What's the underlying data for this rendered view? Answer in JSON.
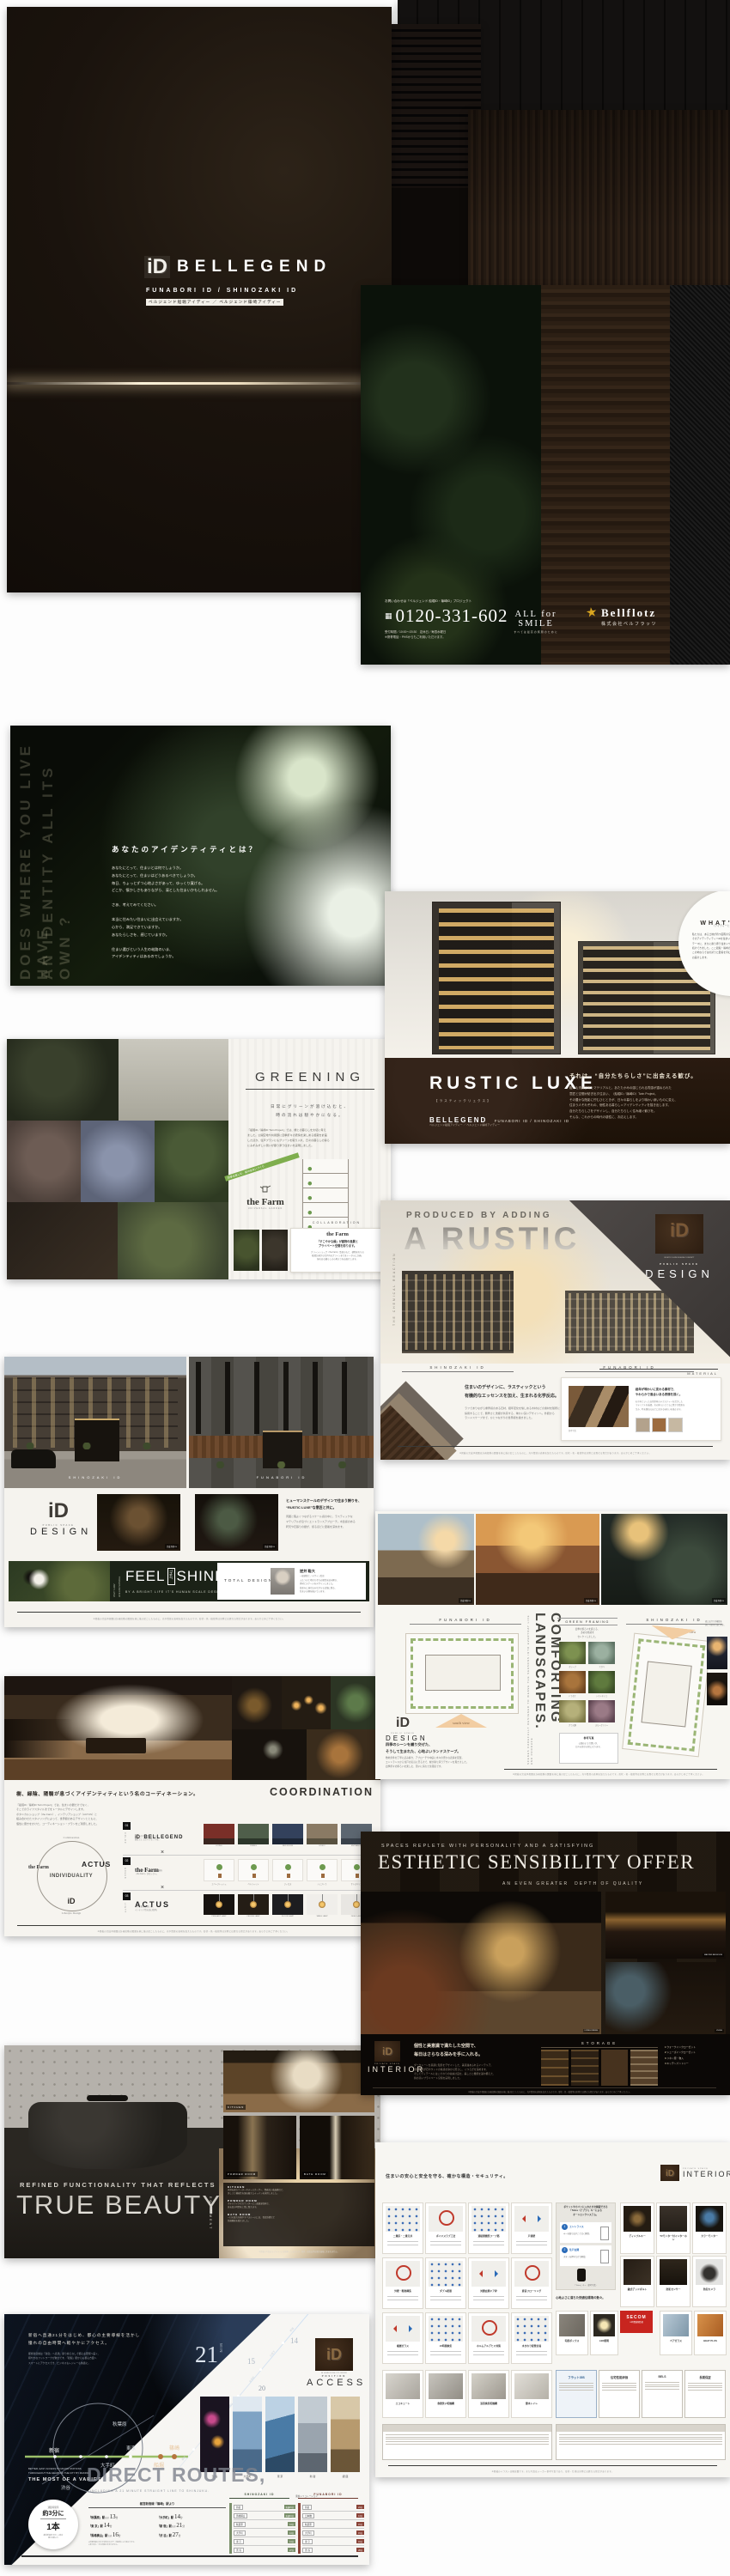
{
  "shared": {
    "cg": "完成予想CG",
    "photo_note": "参考写真",
    "disclaimer": "※掲載の完成予想図は計画段階の図面を基に描き起こしたものに、光や質感の表現を加えたものです。形状・色・植栽等は実際とは異なる場合があります。あらかじめご了承ください。"
  },
  "cover": {
    "mark": "iD",
    "logo": "BELLEGEND",
    "sub_en": "FUNABORI ID / SHINOZAKI ID",
    "sub_jp": "ベルジェンド船堀アイディー ／ ベルジェンド篠崎アイディー"
  },
  "back": {
    "note": "お問い合わせは「ベルジェンド 船堀iD・篠崎iD」プロジェクト",
    "phone": "0120-331-602",
    "hours1": "受付時間／10:00〜20:30　定休日／毎週水曜日",
    "hours2": "※携帯電話・PHSからもご利用いただけます。",
    "slogan": "ALL for SMILE",
    "slogan_jp": "すべては最高の笑顔のために",
    "company": "Bellflotz",
    "company_jp": "株式会社ベルフラッツ"
  },
  "identity": {
    "ven1": "DOES WHERE YOU LIVE HAVE",
    "ven2": "AN IDENTITY ALL ITS OWN ?",
    "headline": "あなたのアイデンティティとは？",
    "para1": [
      "あなたにとって、住まいとは何でしょうか。",
      "あなたにとって、住まいはどうあるべきでしょうか。",
      "毎日、ちょっとずつ心地よさがあって、ゆっくり寛げる。",
      "どこか、懐かしさもありながら、凛とした住まいかもしれません。"
    ],
    "para2": [
      "さあ、考えてみてください。"
    ],
    "para3": [
      "本当に住みたい住まいに出会えていますか。",
      "心から、満足できていますか。",
      "あなたらしさを、感じていますか。"
    ],
    "para4": [
      "住まい選びという人生の岐路のいま、",
      "アイデンティティはあるのでしょうか。"
    ]
  },
  "luxe": {
    "whats_title": "WHAT'S",
    "whats_mark": "iD",
    "whats_sub": "〈アイディーとは？〉",
    "whats_body": [
      "私たちは、ある土地が持つ固有の空気感を大切に、",
      "そのアイデンティティ＝iDを住まいに映すことを",
      "テーマに、まちに寄り添う住まいづくりを",
      "続けてきました。ここ船堀・篠崎の地でも、",
      "この地ならではの誇りと愛着を育む住まいを",
      "お届けします。"
    ],
    "logo": "RUSTIC LUXE",
    "logo_sub": "【ラスティックリュクス】",
    "brand": "BELLEGEND",
    "brand_sub": "FUNABORI ID / SHINOZAKI ID",
    "brand_jp": "ベルジェンド船堀アイディー ／ ベルジェンド篠崎アイディー",
    "headline": "それは、“自分たちらしさ”に出会える歓び。",
    "body": [
      "粗くも洗練されたマテリアルと、あたたかみの感じられる質感が重ねられた",
      "意匠と空間が紡ぎ出す住まい、〈船堀iD／篠崎iD〉Twin Project。",
      "その豊かな陰影に佇むひとときが、日々の暮らしをより味わい深いものに変え、",
      "住まう人それぞれの、個性ある暮らし＝アイデンティティを描き出します。",
      "自分たちらしさをデザインし、自分たちらしく住み継ぐ歓びを。",
      "そんな、これからの時代の感性に、お応えします。"
    ]
  },
  "greening": {
    "title": "GREENING",
    "sub": [
      "日常にグリーンが溶け込むと、",
      "時の流れは穏やかになる。"
    ],
    "body": [
      "『船堀iD／篠崎iD Twin Project』では、緑との暮らしを大切に考え",
      "ました。公開空地や共用部に四季折々の表情を楽しめる植栽を計画",
      "したほか、住戸プランにもグリーンを取り入れ、日々の暮らしの傍ら",
      "にみずみずしい潤いが寄り添う住まいを実現しました。"
    ],
    "banner": "四季を楽しむ、緑の住まいづくり",
    "farm": "the Farm",
    "farm_sub": "UNIVERSAL GARDEN",
    "diagram_label": "植栽計画概念図",
    "collab_title": "COLLABORATION",
    "collab_farm": "the Farm",
    "collab_head": [
      "「すこやかな緑」が建物の風景と",
      "プライベート空間を彩ります。"
    ],
    "collab_body": [
      "グリーンショップ〈the Farm〉監修のもと、建物まわりの",
      "植栽計画から住戸内のグリーンまでをトータルに計画。",
      "緑のある暮らしの心地よさをお届けします。"
    ]
  },
  "rustic": {
    "eyebrow": "PRODUCED BY ADDING",
    "title": "A RUSTIC",
    "vertical": "THE CHEMICAL REACTION",
    "label_left": "SHINOZAKI ID",
    "label_right": "FUNABORI ID",
    "corner_mark": "iD",
    "corner_note": "RUSTIC LUXE DESIGN CONCEPT",
    "corner_small": "PUBLIC SPACE",
    "corner_big": "DESIGN",
    "mat_head": [
      "住まいのデザインに、ラスティックという",
      "有機的なエッセンスを加え、生まれる化学反応。"
    ],
    "mat_body": [
      "ラフでありながら重厚感のある石材、経年変化を愉しめる木材などの素材を随所に",
      "採用することで、無骨さと洗練が共存する、味わい深いデザインへ。外観から",
      "ランドスケープまで、ひとつながりの世界観を描きました。"
    ],
    "material_title": "MATERIAL",
    "material_head": [
      "経年が味わいに変わる素材で、",
      "やわらかで風合いある表情を描く。"
    ],
    "material_body": [
      "石や木といった自然素材のテクスチャーを活かした",
      "マテリアルを厳選。光の移ろいとともに豊かな陰影を",
      "生み、時を重ねるほどに深まる味わいを描きます。"
    ]
  },
  "facade": {
    "label_left": "SHINOZAKI ID",
    "label_right": "FUNABORI ID",
    "design_mark": "iD",
    "design_small": "PUBLIC SPACE",
    "design_big": "DESIGN",
    "head": [
      "ヒューマンスケールのデザインで住まう誇りを、",
      "“RUSTIC LUXE”な意匠と共に。"
    ],
    "body": [
      "周囲と程よくつながるスケール感の中に、ラスティックな",
      "マテリアルが息づくエントランスアプローチ。木質感のある",
      "軒天や石張りの壁が、帰るほどに愛着を深めます。"
    ],
    "banner_v1": "ONLY “LUXE”",
    "banner_v2": "LIFE AND NATURAL",
    "feel": "FEEL",
    "that": "THAT",
    "shines": "SHINES",
    "banner_sub": "BY A BRIGHT LIFE IT’S HUMAN SCALE DESIGN.",
    "total": "TOTAL DESIGN",
    "person_name": "逆井 聡大",
    "person_title": "一級建築士／デザイン監修",
    "person_body": [
      "ふたつの土地それぞれの個性を読み解き、",
      "素材とスケールをデザインしました。",
      "街並みに溶け込みながらも記憶に残る、",
      "住まいの顔を描いています。"
    ]
  },
  "land": {
    "label_left": "FUNABORI ID",
    "label_right": "SHINOZAKI ID",
    "south_view": "south view",
    "favorite_view": "favorite view",
    "vertical_small": "SCENES CAREFULLY DESIGNED TO WEAVE THE SEASONS INTO EVERYDAY LIFE AND PRODUCE",
    "vertical_big": "COMFORTING LANDSCAPES.",
    "gf_title": "GREEN FRAMING",
    "gf_sub": [
      "四季の移ろいを感じる、",
      "多彩な植栽を",
      "セレクトしました。"
    ],
    "plants": [
      "オリーブ",
      "アガベ",
      "ドラセナ",
      "シマトネリコ",
      "グラス類",
      "スモークツリー"
    ],
    "note_title": "参考写真",
    "note_body": [
      "公園のような潤いが、",
      "日々の寛ぎの場になります。"
    ],
    "side_note": [
      "夜には灯りが植栽を",
      "美しく照らし出します。"
    ],
    "design_mark": "iD",
    "design_small": "PUBLIC SPACE",
    "design_big": "DESIGN",
    "head": [
      "四季のシーンを織り交ぜた、",
      "そうして生まれた、心地よいランドスケープ。"
    ],
    "body": [
      "敷地条件を丁寧に読み解き、アプローチや中庭に木々の豊かな表情を配置。",
      "エントランスから住戸の窓辺に至るまで、緑が寄り添うデザインを貫きました。",
      "四季折々の移ろいを楽しむ、潤いに満ちた住環境です。"
    ]
  },
  "coord": {
    "headline": "樹、緑陰、陽翳が息づくアイデンティティという名のコーディネーション。",
    "title": "COORDINATION",
    "body": [
      "『船堀iD／篠崎iD Twin Project』では、住まいの器だけでなく、",
      "そこでのライフスタイルまでをトータルにデザインします。",
      "ボタニカルショップ〈the Farm〉、インテリアショップ〈ACTUS〉と",
      "組み合わせたスタイリングによって、世界観のあるデザインとともに、",
      "個性に磨きをかけた、コーディネーション・プランをご用意しました。"
    ],
    "dg_left": "the Farm",
    "dg_right": "ACTUS",
    "dg_center": "INDIVIDUALITY",
    "dg_bottom": "iD",
    "dg_top": "Collaboration",
    "dg_under": "Lifestyle Design",
    "x": "×",
    "rows": [
      {
        "num": "01",
        "tag": "COLOR",
        "logo": "BELLEGEND",
        "mark": "iD",
        "sub": [
          "私たちが手掛ける住まいに、",
          "個性としてのアクセントを。"
        ],
        "items": [
          "LIVING",
          "DINING",
          "BED ROOM",
          "STUDY",
          "ENTRANCE"
        ]
      },
      {
        "num": "02",
        "tag": "GREEN",
        "logo": "the Farm",
        "mark": "",
        "sub": [
          "暮らしのパートナーになる緑を",
          "〈the Farm〉がセレクト。"
        ],
        "items": [
          "エバーフレッシュ",
          "ベンジャミン",
          "フィカス",
          "シェフレラ",
          "サンスベリア"
        ]
      },
      {
        "num": "03",
        "tag": "LIGHT",
        "logo": "ACTUS",
        "mark": "",
        "sub": [
          "ラフに配して愉しむ、",
          "インテリア性の高い照明。"
        ],
        "items": [
          "PENDANT LAMP",
          "CEILING LAMP",
          "FLOOR LAMP",
          "TABLE LAMP",
          "DESK LAMP"
        ]
      }
    ]
  },
  "esthetic": {
    "eyebrow": "SPACES REPLETE WITH PERSONALITY AND A SATISFYING",
    "title": "ESTHETIC SENSIBILITY OFFER",
    "sub": "AN EVEN GREATER　DEPTH OF QUALITY",
    "cap_main": "LIVING DINING",
    "cap_bed": "MASTER BEDROOM",
    "cap_liv": "LIVING",
    "mark": "iD",
    "small": "PRIVATE SPACE",
    "big": "INTERIOR",
    "head": [
      "個性と美意識で満たした空間で、",
      "毎日はさらなる深みを手に入れる。"
    ],
    "body": [
      "ダークトーンを基調に陰影をデザインした、美意識あふれるインテリア。",
      "間接照明が石やウッドの質感を静かに照らし、くつろぎを深めます。",
      "そしてディテールにはこだわりの収納計画を。美しさと機能を兼ね備えた、",
      "質の高いプライベート空間を実現しました。"
    ],
    "storage": "STORAGE",
    "items": [
      {
        "n": "1",
        "t": "ウォークインクローゼット"
      },
      {
        "n": "2",
        "t": "シューズインクローゼット"
      },
      {
        "n": "3",
        "t": "リネン庫・物入"
      },
      {
        "n": "4",
        "t": "キッチンパントリー"
      }
    ]
  },
  "beauty": {
    "eyebrow": "REFINED FUNCTIONALITY THAT REFLECTS",
    "title": "TRUE BEAUTY",
    "side": "EQUIPMENT",
    "cap_kitchen": "KITCHEN",
    "cap_powder": "POWDER ROOM",
    "cap_bath": "BATH ROOM",
    "sections": [
      {
        "h": "KITCHEN",
        "l1": "天然石調カウンターやディスポーザー、食器洗い乾燥機など、",
        "l2": "美しさと機能性を兼ね備えたキッチンを採用しました。"
      },
      {
        "h": "POWDER ROOM",
        "l1": "ホテルライクなカウンターと三面鏡裏収納で、",
        "l2": "身支度の時間を上質に整えます。"
      },
      {
        "h": "BATH ROOM",
        "l1": "一日の疲れを癒やすバスルームには、保温浴槽など",
        "l2": "快適機能を備えました。"
      }
    ],
    "caption": "※掲載の写真はモデルルームを撮影したものです。家具・調度品等は販売価格に含まれません。"
  },
  "specs": {
    "headline": "住まいの安心と安全を守る、確かな構造・セキュリティ。",
    "mark": "iD",
    "logo_small": "PRIVATE SPACE",
    "logo_big": "INTERIOR",
    "struct_cards": [
      "二重床・二重天井",
      "ボイドスラブ工法",
      "溶接閉鎖型フープ筋",
      "戸境壁",
      "外壁・断熱構造",
      "ダブル配筋",
      "対震玄関ドア枠",
      "遮音フローリング",
      "複層ガラス",
      "24時間換気",
      "ホルムアルデヒド対策",
      "水まわり配管計画"
    ],
    "tebra_title": [
      "ポケットやカバンに入れたまま解錠できる",
      "「Tebra（テブラ）」キーによる",
      "オートロックシステム。"
    ],
    "steps": [
      {
        "n": "1",
        "t": "エントランス",
        "d": "キーを取り出すことなく解錠。"
      },
      {
        "n": "2",
        "t": "住戸玄関",
        "d": "ボタンを押すだけで解錠。"
      }
    ],
    "key_note": "「Tebra」キー（参考写真）",
    "sec_cards": [
      "ディンプルキー",
      "TVモニター付インターホン",
      "カラーモニター",
      "鎌式デッドボルト",
      "防犯センサー",
      "防犯カメラ"
    ],
    "secom": "SECOM",
    "secom_note": "24時間遠隔監視",
    "comfort_head": "心地よさに満ちた快適住環境の数々。",
    "comfort_cards": [
      "ペアガラス",
      "HEAT PLUS",
      "宅配ボックス",
      "LED照明"
    ],
    "extra_cards": [
      "エコキュート",
      "食器洗い乾燥機",
      "浴室換気乾燥機",
      "節水トイレ"
    ],
    "cert_cards": [
      "フラット35S",
      "住宅性能評価",
      "BELS",
      "長期保証"
    ],
    "caption": "※掲載のイラストは概念図です。また写真はメーカー参考写真であり、形状・仕様は実際とは異なる場合があります。"
  },
  "access": {
    "head": [
      "新宿へ直通21分をはじめ、都心の主要導線を活かし",
      "憧れの自由時間へ軽やかにアクセス。"
    ],
    "body": [
      "都営新宿線は「新宿」へ直通。乗り換えなしで都心主要駅へ届く、",
      "軽やかなフットワークが魅力です。「船堀」駅からも都心方面へ",
      "スマートにアクセスでき、ビジネスもレジャーも快適に。"
    ],
    "map": {
      "shinjuku": "新宿",
      "shibuya": "渋谷",
      "tokyo": "東京",
      "akihabara": "秋葉原",
      "otemachi": "大手町",
      "funabori": "船堀",
      "shinozaki": "篠崎"
    },
    "big_num": "21",
    "big_unit": "MIN",
    "nums": [
      "15",
      "14",
      "20"
    ],
    "route": [
      "篠崎",
      "船堀",
      "馬喰横山",
      "大手町",
      "九段下",
      "新宿"
    ],
    "position_mark": "iD",
    "position_note": "AT HOME IN THE CITY CENTER",
    "position_small": "POSITION",
    "position_big": "ACCESS",
    "photo_caps": [
      "渋 谷",
      "大手町",
      "東 京",
      "新 宿",
      "銀 座"
    ],
    "dr_eyebrow1": "BETTER, EASY ACCESS TO MAJOR STATIONS",
    "dr_eyebrow2": "THROUGHOUT THE HEART OF THE CITY BY MAKING",
    "dr_eyebrow3": "THE MOST OF A VARIETY OF",
    "dr_title": "DIRECT ROUTES,",
    "dr_sub": "INCLUDING A 21 MINUTE STRAIGHT LINE TO SHINJUKU.",
    "badge": {
      "l1": "通勤時間帯",
      "big": "約3分に",
      "num": "1本",
      "n1": "都営新宿線 平日7〜9時台",
      "n2": "運行本数より"
    },
    "list_title": "都営新宿線「篠崎」駅より",
    "min_unit": "分",
    "list": [
      {
        "s": "「秋葉原」駅",
        "n": "直通",
        "m": "13"
      },
      {
        "s": "「大手町」駅",
        "n": "",
        "m": "14"
      },
      {
        "s": "「東 京」駅",
        "n": "",
        "m": "14"
      },
      {
        "s": "「新 宿」駅",
        "n": "直通",
        "m": "21"
      },
      {
        "s": "「馬喰横山」駅",
        "n": "直通",
        "m": "16"
      },
      {
        "s": "「渋 谷」駅",
        "n": "",
        "m": "27"
      }
    ],
    "list_notes": [
      "※所要時間は日中平常時のもので、時間帯により異なります。",
      "※乗り換え・待ち時間は含まれません。"
    ],
    "t_left": "SHINOZAKI ID",
    "t_center": "乗換シミュレーション",
    "t_right": "FUNABORI ID",
    "tl": [
      {
        "to": "新宿",
        "t": "直通21分"
      },
      {
        "to": "馬喰横山",
        "t": "直通16分"
      },
      {
        "to": "秋葉原",
        "t": "13分"
      },
      {
        "to": "大手町",
        "t": "14分"
      },
      {
        "to": "東 京",
        "t": "14分"
      },
      {
        "to": "渋 谷",
        "t": "27分"
      }
    ],
    "tr": [
      {
        "to": "新宿",
        "t": "24分"
      },
      {
        "to": "日本橋",
        "t": "13分"
      },
      {
        "to": "秋葉原",
        "t": "15分"
      },
      {
        "to": "大手町",
        "t": "15分"
      },
      {
        "to": "東 京",
        "t": "16分"
      },
      {
        "to": "渋 谷",
        "t": "28分"
      }
    ]
  }
}
